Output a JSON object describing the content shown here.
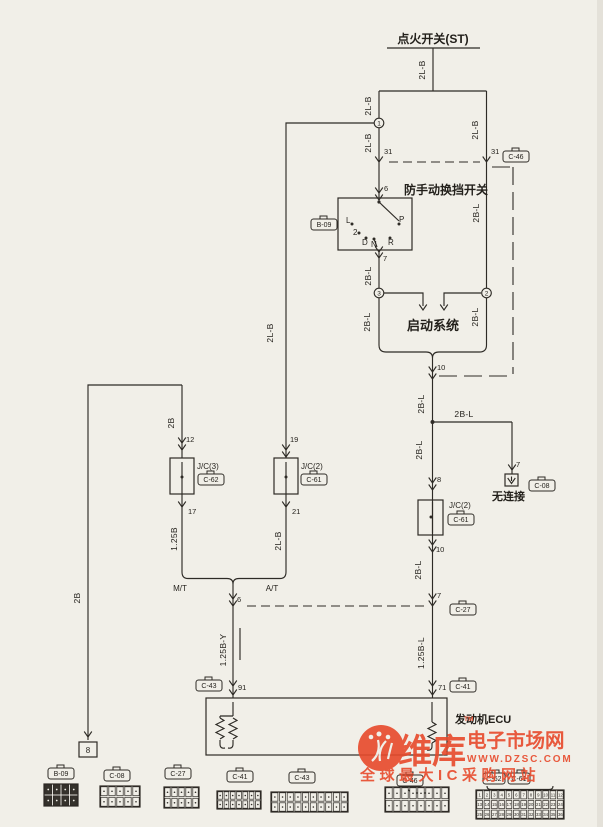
{
  "diagram": {
    "title": "点火开关(ST)",
    "switch": {
      "name": "防手动换挡开关",
      "positions": [
        "L",
        "2",
        "D",
        "N",
        "R",
        "P"
      ]
    },
    "starting_system": "启动系统",
    "no_connection": "无连接",
    "ecu": "发动机ECU",
    "mt": "M/T",
    "at": "A/T",
    "continuation": "8",
    "junction": {
      "top": "1",
      "left": "3",
      "right": "2"
    },
    "pin": {
      "ign": "31",
      "sw_in": "6",
      "sw_out": "7",
      "start_out": "10",
      "nc": "7",
      "jc2r_in": "8",
      "jc2r_out": "10",
      "c27r": "7",
      "c41": "71",
      "c43": "91",
      "jc3_in": "12",
      "jc3_out": "17",
      "jc2l_in": "19",
      "jc2l_out": "21",
      "c27l": "6"
    },
    "wire": {
      "top": "2L-B",
      "left_upper": "2L-B",
      "left_lower": "2L-B",
      "right_upper": "2L-B",
      "right_lower": "2B-L",
      "sw_out": "2B-L",
      "below_j3": "2B-L",
      "below_j2": "2B-L",
      "trunk": "2L-B",
      "after_start": "2B-L",
      "nc_branch": "2B-L",
      "to_jc2r": "2B-L",
      "jc2r_out": "2B-L",
      "to_c41": "1.25B-L",
      "far_left": "2B",
      "to_jc3": "2B",
      "jc3_out": "1.25B",
      "jc2l_out": "2L-B",
      "to_c43": "1.25B-Y"
    },
    "ref": {
      "c46": "C-46",
      "b09": "B-09",
      "c08": "C-08",
      "c27": "C-27",
      "c41": "C-41",
      "c43": "C-43",
      "c62": "C-62",
      "c61": "C-61",
      "jc2": "J/C(2)",
      "jc3": "J/C(3)"
    }
  },
  "watermark": {
    "brand": "维库",
    "suffix": "电子市场网",
    "tm": "TM",
    "url": "WWW.DZSC.COM",
    "tagline": "全球最大IC采购网站"
  }
}
